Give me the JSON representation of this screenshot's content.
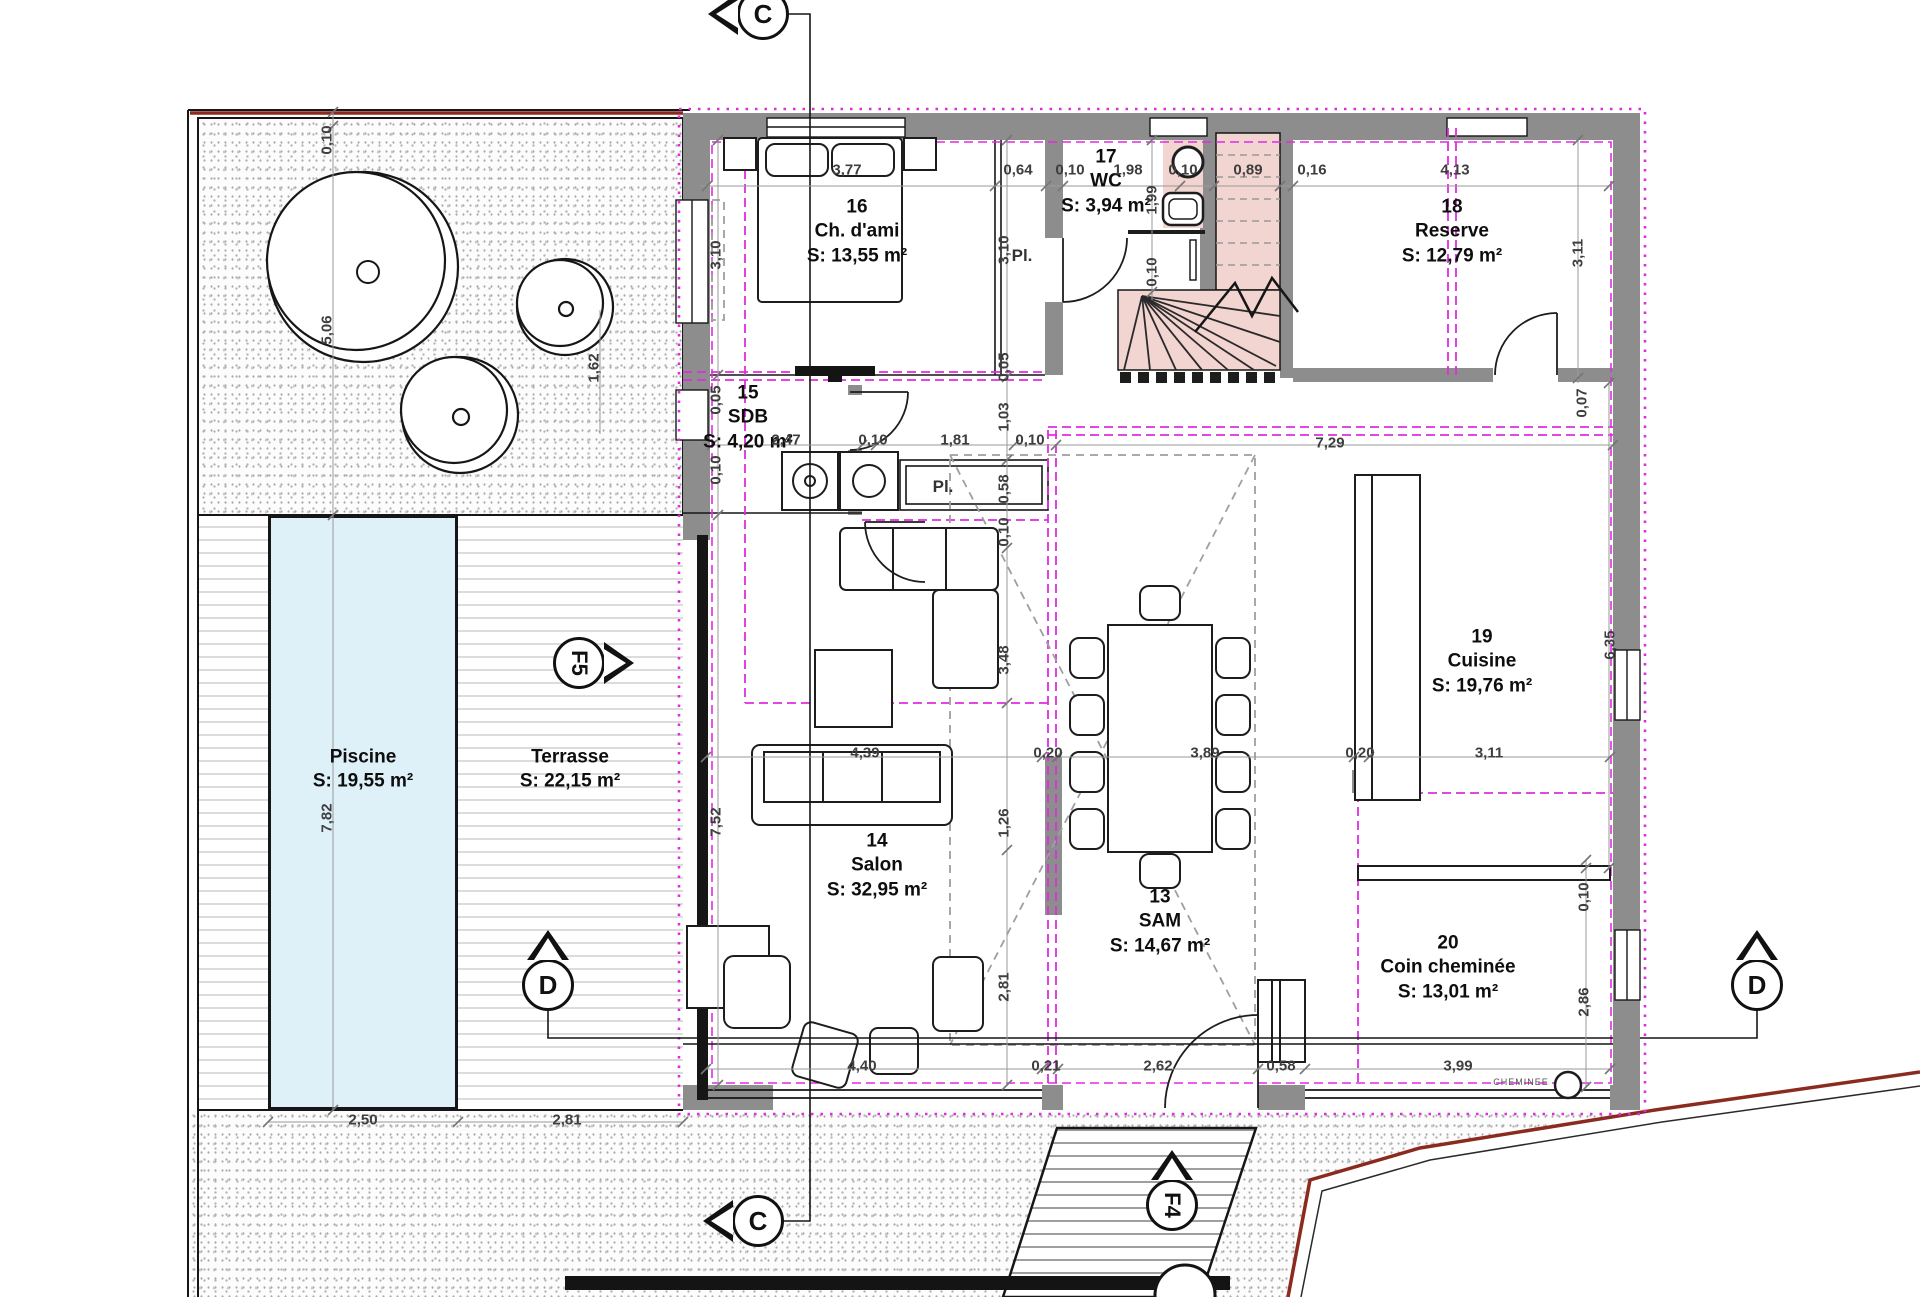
{
  "plan_title": "Floor plan - level with living areas",
  "colors": {
    "wall_gray": "#8d8d8d",
    "magenta_boundary": "#e02ce0",
    "stair_pink": "#f2d4d0",
    "pool_blue": "#def0f8",
    "property_line_red": "#8b2a1e",
    "dim_text": "#3e3e3e"
  },
  "rooms": [
    {
      "id": "13",
      "name": "SAM",
      "area": "S: 14,67 m²",
      "x": 1160,
      "y": 922
    },
    {
      "id": "14",
      "name": "Salon",
      "area": "S: 32,95 m²",
      "x": 877,
      "y": 866
    },
    {
      "id": "15",
      "name": "SDB",
      "area": "S: 4,20 m²",
      "x": 748,
      "y": 418
    },
    {
      "id": "16",
      "name": "Ch. d'ami",
      "area": "S: 13,55 m²",
      "x": 857,
      "y": 232
    },
    {
      "id": "17",
      "name": "WC",
      "area": "S: 3,94 m²",
      "x": 1106,
      "y": 182
    },
    {
      "id": "18",
      "name": "Reserve",
      "area": "S: 12,79 m²",
      "x": 1452,
      "y": 232
    },
    {
      "id": "19",
      "name": "Cuisine",
      "area": "S: 19,76 m²",
      "x": 1482,
      "y": 662
    },
    {
      "id": "20",
      "name": "Coin cheminée",
      "area": "S: 13,01 m²",
      "x": 1448,
      "y": 968
    },
    {
      "id": "",
      "name": "Piscine",
      "area": "S: 19,55 m²",
      "x": 363,
      "y": 770
    },
    {
      "id": "",
      "name": "Terrasse",
      "area": "S: 22,15 m²",
      "x": 570,
      "y": 770
    }
  ],
  "dimensions": [
    {
      "v": "3,77",
      "x": 847,
      "y": 170
    },
    {
      "v": "0,64",
      "x": 1018,
      "y": 170
    },
    {
      "v": "0,10",
      "x": 1070,
      "y": 170
    },
    {
      "v": "1,98",
      "x": 1128,
      "y": 170
    },
    {
      "v": "0,10",
      "x": 1183,
      "y": 170
    },
    {
      "v": "0,89",
      "x": 1248,
      "y": 170
    },
    {
      "v": "0,16",
      "x": 1312,
      "y": 170
    },
    {
      "v": "4,13",
      "x": 1455,
      "y": 170
    },
    {
      "v": "3,10",
      "x": 716,
      "y": 255,
      "r": 1
    },
    {
      "v": "0,05",
      "x": 716,
      "y": 400,
      "r": 1
    },
    {
      "v": "0,10",
      "x": 716,
      "y": 470,
      "r": 1
    },
    {
      "v": "1,62",
      "x": 594,
      "y": 368,
      "r": 1
    },
    {
      "v": "7,52",
      "x": 716,
      "y": 822,
      "r": 1
    },
    {
      "v": "0,10",
      "x": 327,
      "y": 140,
      "r": 1
    },
    {
      "v": "5,06",
      "x": 327,
      "y": 330,
      "r": 1
    },
    {
      "v": "7,82",
      "x": 327,
      "y": 818,
      "r": 1
    },
    {
      "v": "3,10",
      "x": 1004,
      "y": 250,
      "r": 1
    },
    {
      "v": "0,05",
      "x": 1004,
      "y": 367,
      "r": 1
    },
    {
      "v": "1,03",
      "x": 1004,
      "y": 417,
      "r": 1
    },
    {
      "v": "0,58",
      "x": 1004,
      "y": 489,
      "r": 1
    },
    {
      "v": "0,10",
      "x": 1004,
      "y": 532,
      "r": 1
    },
    {
      "v": "3,48",
      "x": 1004,
      "y": 660,
      "r": 1
    },
    {
      "v": "1,26",
      "x": 1004,
      "y": 823,
      "r": 1
    },
    {
      "v": "2,81",
      "x": 1004,
      "y": 987,
      "r": 1
    },
    {
      "v": "1,99",
      "x": 1152,
      "y": 200,
      "r": 1
    },
    {
      "v": "0,10",
      "x": 1152,
      "y": 272,
      "r": 1
    },
    {
      "v": "2,47",
      "x": 786,
      "y": 440
    },
    {
      "v": "0,10",
      "x": 873,
      "y": 440
    },
    {
      "v": "1,81",
      "x": 955,
      "y": 440
    },
    {
      "v": "0,10",
      "x": 1030,
      "y": 440
    },
    {
      "v": "7,29",
      "x": 1330,
      "y": 443
    },
    {
      "v": "3,11",
      "x": 1578,
      "y": 253,
      "r": 1
    },
    {
      "v": "0,07",
      "x": 1582,
      "y": 403,
      "r": 1
    },
    {
      "v": "6,35",
      "x": 1610,
      "y": 645,
      "r": 1
    },
    {
      "v": "4,39",
      "x": 865,
      "y": 753
    },
    {
      "v": "0,20",
      "x": 1048,
      "y": 753
    },
    {
      "v": "3,89",
      "x": 1205,
      "y": 753
    },
    {
      "v": "0,20",
      "x": 1360,
      "y": 753
    },
    {
      "v": "3,11",
      "x": 1489,
      "y": 753
    },
    {
      "v": "0,10",
      "x": 1584,
      "y": 897,
      "r": 1
    },
    {
      "v": "2,86",
      "x": 1584,
      "y": 1002,
      "r": 1
    },
    {
      "v": "4,40",
      "x": 862,
      "y": 1066
    },
    {
      "v": "0,21",
      "x": 1046,
      "y": 1066
    },
    {
      "v": "2,62",
      "x": 1158,
      "y": 1066
    },
    {
      "v": "0,58",
      "x": 1281,
      "y": 1066
    },
    {
      "v": "3,99",
      "x": 1458,
      "y": 1066
    },
    {
      "v": "2,50",
      "x": 363,
      "y": 1120
    },
    {
      "v": "2,81",
      "x": 567,
      "y": 1120
    }
  ],
  "markers": [
    {
      "t": "C",
      "x": 763,
      "y": 14,
      "tri": "left"
    },
    {
      "t": "C",
      "x": 758,
      "y": 1221,
      "tri": "left"
    },
    {
      "t": "D",
      "x": 548,
      "y": 985,
      "tri": "up"
    },
    {
      "t": "D",
      "x": 1757,
      "y": 985,
      "tri": "up"
    },
    {
      "t": "F5",
      "x": 579,
      "y": 663,
      "tri": "right",
      "rot": 1
    },
    {
      "t": "F4",
      "x": 1172,
      "y": 1205,
      "tri": "up",
      "rot": 1
    }
  ],
  "annotations": [
    {
      "t": "Pl.",
      "x": 1022,
      "y": 256,
      "size": 17
    },
    {
      "t": "Pl.",
      "x": 943,
      "y": 487,
      "size": 17
    },
    {
      "t": "CHEMINEE",
      "x": 1521,
      "y": 1082,
      "size": 9
    }
  ]
}
